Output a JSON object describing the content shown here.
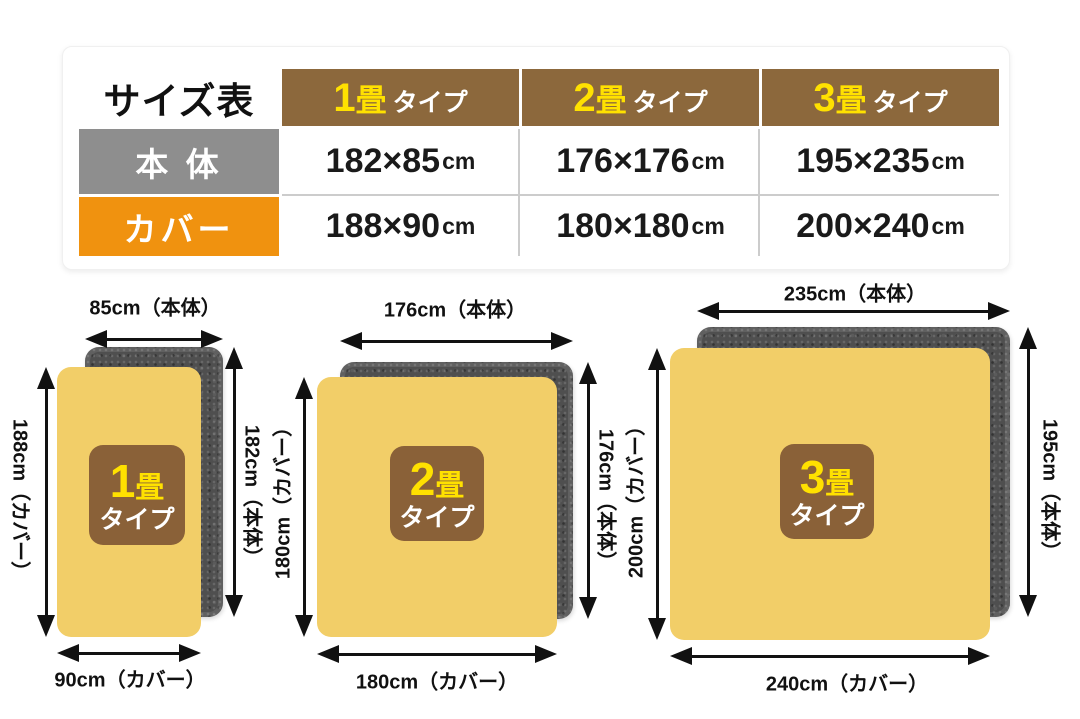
{
  "colors": {
    "header_brown": "#8c683c",
    "badge_brown": "#8a6138",
    "accent_yellow": "#ffe100",
    "row_body_gray": "#8e8e8e",
    "row_cover_orange": "#f0920f",
    "mat_cover_yellow": "#f2ce68",
    "mat_body_gray": "#4f4f4f"
  },
  "size_table": {
    "title": "サイズ表",
    "columns": [
      {
        "num": "1",
        "tatami": "畳",
        "suffix": "タイプ"
      },
      {
        "num": "2",
        "tatami": "畳",
        "suffix": "タイプ"
      },
      {
        "num": "3",
        "tatami": "畳",
        "suffix": "タイプ"
      }
    ],
    "rows": [
      {
        "label": "本 体",
        "values": [
          {
            "dims": "182×85",
            "unit": "cm"
          },
          {
            "dims": "176×176",
            "unit": "cm"
          },
          {
            "dims": "195×235",
            "unit": "cm"
          }
        ]
      },
      {
        "label": "カバー",
        "values": [
          {
            "dims": "188×90",
            "unit": "cm"
          },
          {
            "dims": "180×180",
            "unit": "cm"
          },
          {
            "dims": "200×240",
            "unit": "cm"
          }
        ]
      }
    ]
  },
  "diagrams": [
    {
      "badge": {
        "num": "1",
        "tatami": "畳",
        "line2": "タイプ"
      },
      "top_label": "85cm（本体）",
      "bottom_label": "90cm（カバー）",
      "left_label": "188cm（カバー）",
      "right_label": "182cm（本体）"
    },
    {
      "badge": {
        "num": "2",
        "tatami": "畳",
        "line2": "タイプ"
      },
      "top_label": "176cm（本体）",
      "bottom_label": "180cm（カバー）",
      "left_label": "180cm（カバー）",
      "right_label": "176cm（本体）"
    },
    {
      "badge": {
        "num": "3",
        "tatami": "畳",
        "line2": "タイプ"
      },
      "top_label": "235cm（本体）",
      "bottom_label": "240cm（カバー）",
      "left_label": "200cm（カバー）",
      "right_label": "195cm（本体）"
    }
  ]
}
